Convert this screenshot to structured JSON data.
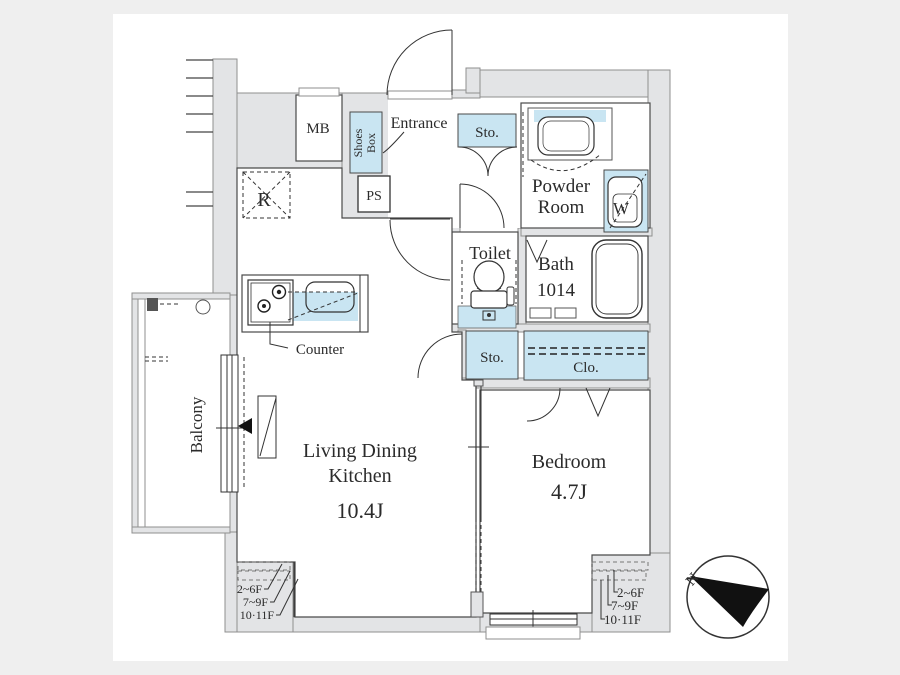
{
  "meta": {
    "type": "apartment-floor-plan",
    "colors": {
      "page_background": "#efefef",
      "plan_background": "#ffffff",
      "wall_fill": "#e3e4e6",
      "fixture_blue": "#c9e5f2",
      "line": "#333333",
      "text": "#2b2b2b"
    }
  },
  "plan": {
    "rooms": {
      "mb": "MB",
      "shoes_box": [
        "Shoes",
        "Box"
      ],
      "entrance": "Entrance",
      "ps": "PS",
      "fridge": "R",
      "storage_top": "Sto.",
      "powder_room": [
        "Powder",
        "Room"
      ],
      "washer": "W",
      "toilet": "Toilet",
      "bath": [
        "Bath",
        "1014"
      ],
      "storage_mid": "Sto.",
      "closet": "Clo.",
      "ldk": [
        "Living Dining",
        "Kitchen"
      ],
      "ldk_size": "10.4J",
      "bedroom": "Bedroom",
      "bedroom_size": "4.7J",
      "balcony": "Balcony"
    },
    "annotations": {
      "counter": "Counter",
      "floors_left": [
        "2~6F",
        "7~9F",
        "10·11F"
      ],
      "floors_right": [
        "2~6F",
        "7~9F",
        "10·11F"
      ],
      "compass_north": "N"
    }
  }
}
